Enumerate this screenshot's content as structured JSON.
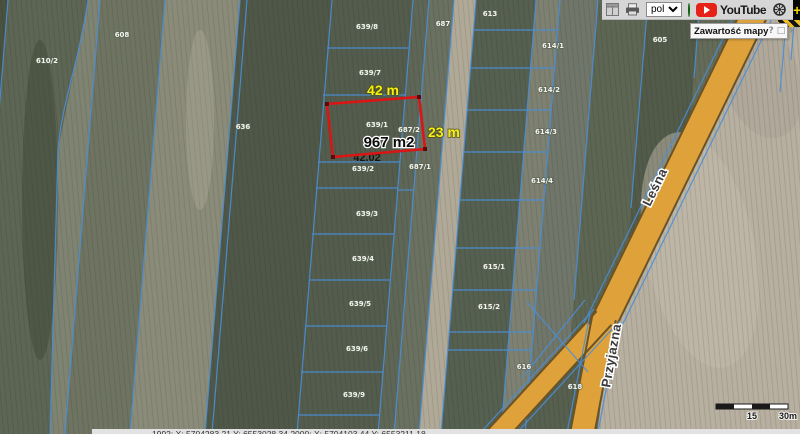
{
  "toolbar": {
    "language_value": "pol",
    "youtube_label": "YouTube",
    "plus_label": "+"
  },
  "panel": {
    "title": "Zawartość mapy",
    "help_label": "?",
    "restore_label": "□",
    "close_label": "×"
  },
  "measurement": {
    "width_label": "42 m",
    "height_label": "23 m",
    "area_label": "967 m2",
    "segment_label": "42.02",
    "outline_color": "#dd1414",
    "label_color": "#f4ee14"
  },
  "roads": [
    {
      "name": "Leśna"
    },
    {
      "name": "Przyjazna"
    }
  ],
  "parcels": [
    {
      "label": "610/2",
      "x": 47,
      "y": 63
    },
    {
      "label": "608",
      "x": 122,
      "y": 37
    },
    {
      "label": "636",
      "x": 243,
      "y": 129
    },
    {
      "label": "639/8",
      "x": 367,
      "y": 29
    },
    {
      "label": "687",
      "x": 443,
      "y": 26
    },
    {
      "label": "639/7",
      "x": 370,
      "y": 75
    },
    {
      "label": "639/1",
      "x": 377,
      "y": 127
    },
    {
      "label": "687/2",
      "x": 409,
      "y": 132
    },
    {
      "label": "639/2",
      "x": 363,
      "y": 171
    },
    {
      "label": "687/1",
      "x": 420,
      "y": 169
    },
    {
      "label": "639/3",
      "x": 367,
      "y": 216
    },
    {
      "label": "639/4",
      "x": 363,
      "y": 261
    },
    {
      "label": "639/5",
      "x": 360,
      "y": 306
    },
    {
      "label": "639/6",
      "x": 357,
      "y": 351
    },
    {
      "label": "639/9",
      "x": 354,
      "y": 397
    },
    {
      "label": "613",
      "x": 490,
      "y": 16
    },
    {
      "label": "614/1",
      "x": 553,
      "y": 48
    },
    {
      "label": "614/2",
      "x": 549,
      "y": 92
    },
    {
      "label": "614/3",
      "x": 546,
      "y": 134
    },
    {
      "label": "614/4",
      "x": 542,
      "y": 183
    },
    {
      "label": "615/1",
      "x": 494,
      "y": 269
    },
    {
      "label": "615/2",
      "x": 489,
      "y": 309
    },
    {
      "label": "616",
      "x": 524,
      "y": 369
    },
    {
      "label": "605",
      "x": 660,
      "y": 42
    },
    {
      "label": "618",
      "x": 575,
      "y": 389
    }
  ],
  "scalebar": {
    "mid_label": "15",
    "end_label": "30m"
  },
  "statusbar": {
    "text": "1992:  X: 5704283.21   Y: 6553028.34        2000:  X: 5704103.44   Y: 6553211.18"
  }
}
